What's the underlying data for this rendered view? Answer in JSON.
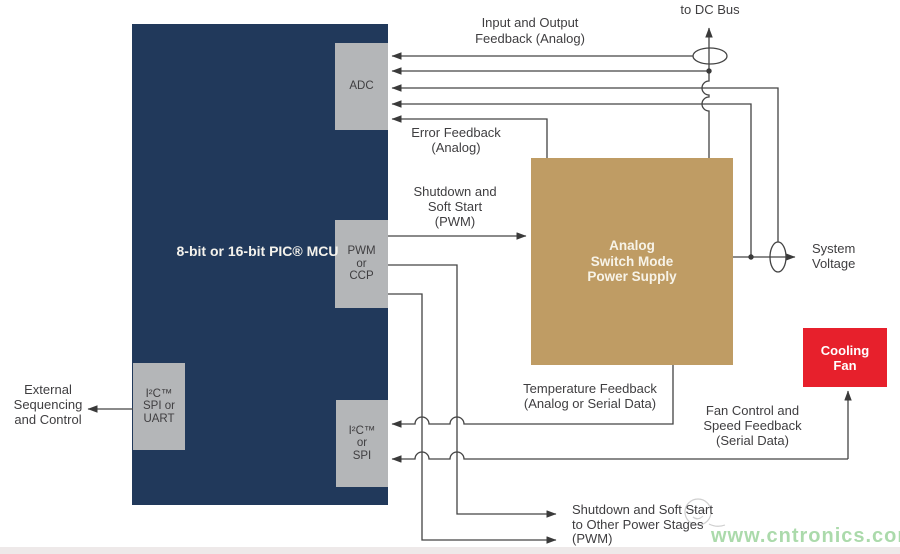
{
  "diagram": {
    "title_hint": "PIC MCU analog switch mode power supply control block diagram",
    "blocks": {
      "mcu": {
        "line1": "8-bit or 16-bit",
        "line2": "PIC® MCU",
        "color": "#21395b"
      },
      "adc": {
        "label": "ADC",
        "color": "#b4b6b8"
      },
      "pwm": {
        "line1": "PWM",
        "line2": "or",
        "line3": "CCP",
        "color": "#b4b6b8"
      },
      "i2c_spi": {
        "line1": "I²C™",
        "line2": "or",
        "line3": "SPI",
        "color": "#b4b6b8"
      },
      "i2c_spi_uart": {
        "line1": "I²C™",
        "line2": "SPI or",
        "line3": "UART",
        "color": "#b4b6b8"
      },
      "psu": {
        "line1": "Analog",
        "line2": "Switch Mode",
        "line3": "Power Supply",
        "color": "#bf9c64"
      },
      "fan": {
        "line1": "Cooling",
        "line2": "Fan",
        "color": "#e7202c"
      }
    },
    "labels": {
      "to_dc_bus": "to DC Bus",
      "input_output_feedback": {
        "line1": "Input and Output",
        "line2": "Feedback (Analog)"
      },
      "error_feedback": {
        "line1": "Error Feedback",
        "line2": "(Analog)"
      },
      "shutdown_soft_start": {
        "line1": "Shutdown and",
        "line2": "Soft Start",
        "line3": "(PWM)"
      },
      "system_voltage": {
        "line1": "System",
        "line2": "Voltage"
      },
      "temperature_feedback": {
        "line1": "Temperature Feedback",
        "line2": "(Analog or Serial Data)"
      },
      "fan_control": {
        "line1": "Fan Control and",
        "line2": "Speed Feedback",
        "line3": "(Serial Data)"
      },
      "external_sequencing": {
        "line1": "External",
        "line2": "Sequencing",
        "line3": "and Control"
      },
      "shutdown_other_stages": {
        "line1": "Shutdown and Soft Start",
        "line2": "to Other Power Stages",
        "line3": "(PWM)"
      }
    },
    "watermark": "www.cntronics.com",
    "colors": {
      "mcu_navy": "#21395b",
      "port_gray": "#b4b6b8",
      "psu_tan": "#bf9c64",
      "fan_red": "#e7202c",
      "wire": "#434343",
      "text": "#3f3e40",
      "watermark_green": "#a3d7a3"
    }
  }
}
